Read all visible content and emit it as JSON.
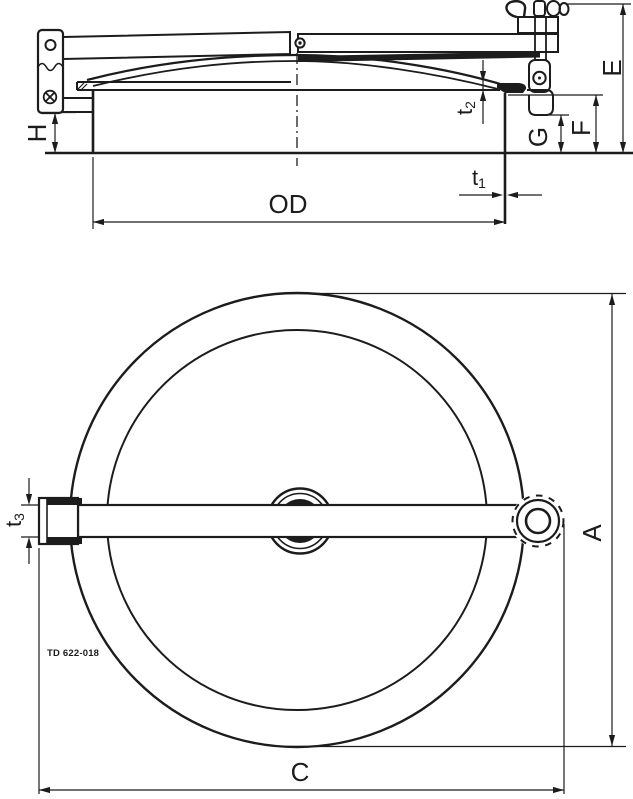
{
  "labels": {
    "e": "E",
    "f": "F",
    "g": "G",
    "h": "H",
    "od": "OD",
    "a": "A",
    "c": "C",
    "t1_base": "t",
    "t1_sub": "1",
    "t2_base": "t",
    "t2_sub": "2",
    "t3_base": "t",
    "t3_sub": "3",
    "drawing_number": "TD 622-018"
  },
  "colors": {
    "line": "#1c1c1c",
    "background": "#ffffff"
  }
}
